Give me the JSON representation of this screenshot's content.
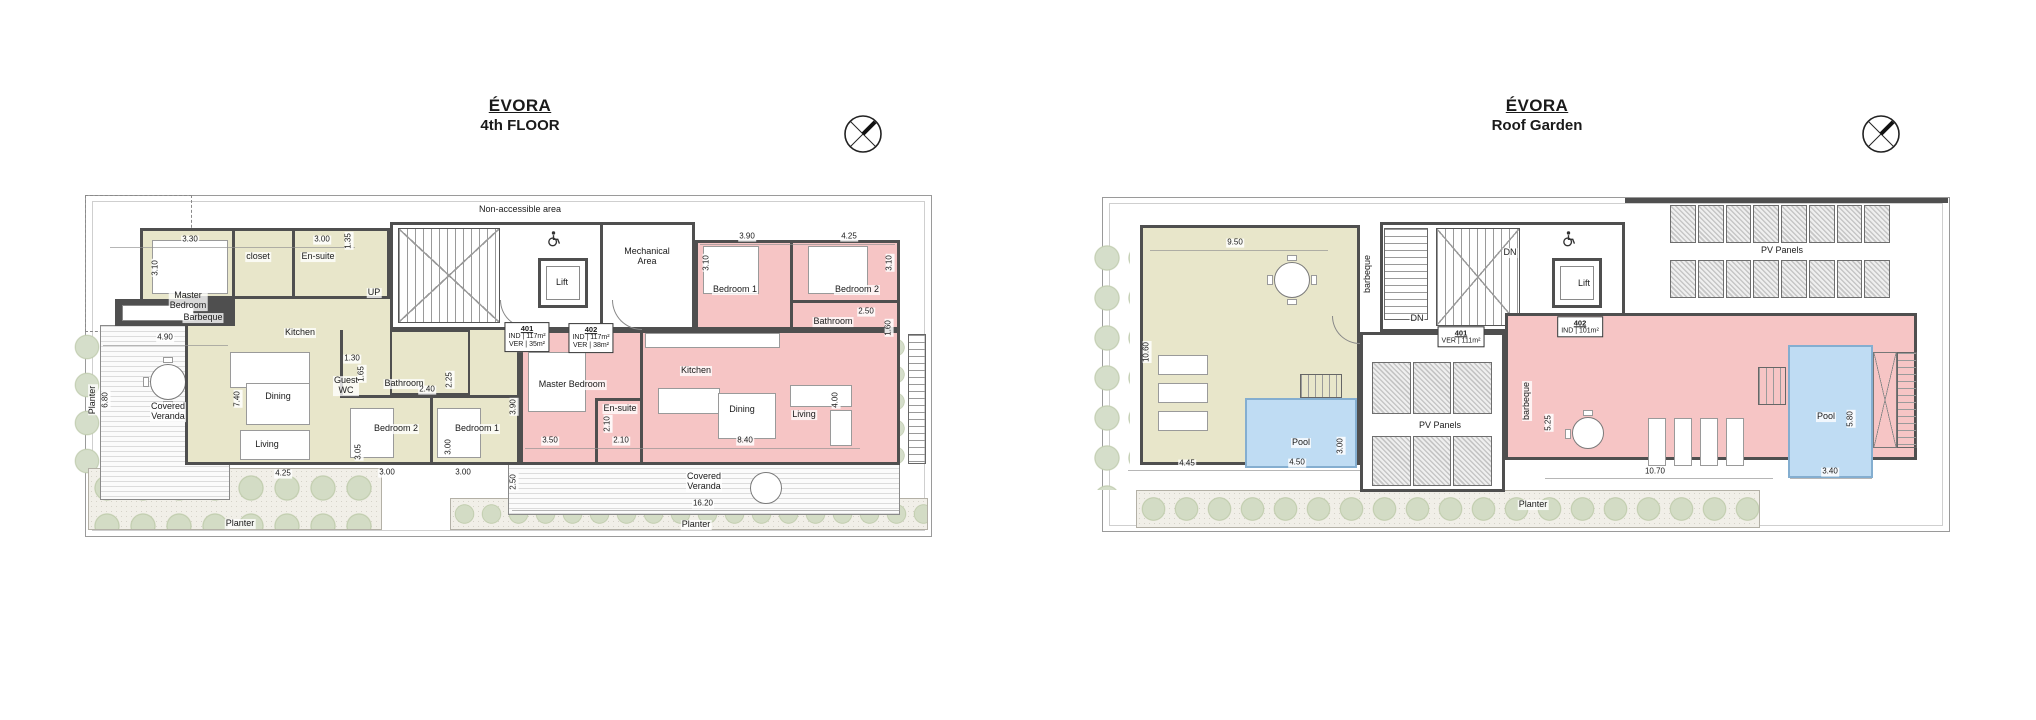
{
  "colors": {
    "unit_401_fill": "#e8e6ca",
    "unit_402_fill": "#f6c5c5",
    "pool_fill": "#bfdcf3",
    "wall": "#4f4f4f",
    "planting": "#d3dcc5"
  },
  "plans": [
    {
      "id": "fourth-floor",
      "title": "ÉVORA",
      "subtitle": "4th FLOOR",
      "room_labels": [
        {
          "t": "Non-accessible area",
          "x": 520,
          "y": 210
        },
        {
          "t": "Master\nBedroom",
          "x": 188,
          "y": 301
        },
        {
          "t": "closet",
          "x": 258,
          "y": 257
        },
        {
          "t": "En-suite",
          "x": 318,
          "y": 257
        },
        {
          "t": "Barbeque",
          "x": 203,
          "y": 318
        },
        {
          "t": "Kitchen",
          "x": 300,
          "y": 333
        },
        {
          "t": "Covered\nVeranda",
          "x": 168,
          "y": 412
        },
        {
          "t": "Dining",
          "x": 278,
          "y": 397
        },
        {
          "t": "Living",
          "x": 267,
          "y": 445
        },
        {
          "t": "Guest\nWC",
          "x": 346,
          "y": 386
        },
        {
          "t": "Bathroom",
          "x": 404,
          "y": 384
        },
        {
          "t": "Bedroom 2",
          "x": 396,
          "y": 429
        },
        {
          "t": "Bedroom 1",
          "x": 477,
          "y": 429
        },
        {
          "t": "UP",
          "x": 374,
          "y": 293
        },
        {
          "t": "Lift",
          "x": 562,
          "y": 283
        },
        {
          "t": "Mechanical\nArea",
          "x": 647,
          "y": 257
        },
        {
          "t": "Master Bedroom",
          "x": 572,
          "y": 385
        },
        {
          "t": "En-suite",
          "x": 620,
          "y": 409
        },
        {
          "t": "Kitchen",
          "x": 696,
          "y": 371
        },
        {
          "t": "Dining",
          "x": 742,
          "y": 410
        },
        {
          "t": "Living",
          "x": 804,
          "y": 415
        },
        {
          "t": "Bathroom",
          "x": 833,
          "y": 322
        },
        {
          "t": "Bedroom 1",
          "x": 735,
          "y": 290
        },
        {
          "t": "Bedroom 2",
          "x": 857,
          "y": 290
        },
        {
          "t": "Covered\nVeranda",
          "x": 704,
          "y": 482
        },
        {
          "t": "Planter",
          "x": 696,
          "y": 525
        },
        {
          "t": "Planter",
          "x": 240,
          "y": 524
        },
        {
          "t": "Planter",
          "x": 93,
          "y": 400,
          "r": -90
        }
      ],
      "dim_labels": [
        {
          "t": "3.30",
          "x": 190,
          "y": 240
        },
        {
          "t": "3.10",
          "x": 156,
          "y": 268,
          "r": -90
        },
        {
          "t": "3.00",
          "x": 322,
          "y": 240
        },
        {
          "t": "1.35",
          "x": 349,
          "y": 241,
          "r": -90
        },
        {
          "t": "4.90",
          "x": 165,
          "y": 338
        },
        {
          "t": "6.80",
          "x": 106,
          "y": 400,
          "r": -90
        },
        {
          "t": "7.40",
          "x": 238,
          "y": 399,
          "r": -90
        },
        {
          "t": "1.30",
          "x": 352,
          "y": 359
        },
        {
          "t": "1.65",
          "x": 362,
          "y": 374,
          "r": -90
        },
        {
          "t": "2.40",
          "x": 427,
          "y": 390
        },
        {
          "t": "2.25",
          "x": 450,
          "y": 380,
          "r": -90
        },
        {
          "t": "3.05",
          "x": 359,
          "y": 452,
          "r": -90
        },
        {
          "t": "3.00",
          "x": 387,
          "y": 473
        },
        {
          "t": "3.00",
          "x": 449,
          "y": 447,
          "r": -90
        },
        {
          "t": "3.00",
          "x": 463,
          "y": 473
        },
        {
          "t": "4.25",
          "x": 283,
          "y": 474
        },
        {
          "t": "3.90",
          "x": 747,
          "y": 237
        },
        {
          "t": "4.25",
          "x": 849,
          "y": 237
        },
        {
          "t": "3.10",
          "x": 707,
          "y": 263,
          "r": -90
        },
        {
          "t": "3.10",
          "x": 890,
          "y": 263,
          "r": -90
        },
        {
          "t": "2.50",
          "x": 866,
          "y": 312
        },
        {
          "t": "1.60",
          "x": 889,
          "y": 328,
          "r": -90
        },
        {
          "t": "3.90",
          "x": 514,
          "y": 407,
          "r": -90
        },
        {
          "t": "3.50",
          "x": 550,
          "y": 441
        },
        {
          "t": "2.10",
          "x": 608,
          "y": 424,
          "r": -90
        },
        {
          "t": "2.10",
          "x": 621,
          "y": 441
        },
        {
          "t": "8.40",
          "x": 745,
          "y": 441
        },
        {
          "t": "4.00",
          "x": 836,
          "y": 400,
          "r": -90
        },
        {
          "t": "2.50",
          "x": 514,
          "y": 482,
          "r": -90
        },
        {
          "t": "16.20",
          "x": 703,
          "y": 504
        }
      ],
      "unit_tags": [
        {
          "lines": [
            "401",
            "IND | 117m²",
            "VER | 35m²"
          ],
          "x": 527,
          "y": 337
        },
        {
          "lines": [
            "402",
            "IND | 117m²",
            "VER | 38m²"
          ],
          "x": 591,
          "y": 338
        }
      ]
    },
    {
      "id": "roof-garden",
      "title": "ÉVORA",
      "subtitle": "Roof Garden",
      "room_labels": [
        {
          "t": "barbeque",
          "x": 1368,
          "y": 274,
          "r": -90
        },
        {
          "t": "DN",
          "x": 1510,
          "y": 253
        },
        {
          "t": "Lift",
          "x": 1584,
          "y": 284
        },
        {
          "t": "PV Panels",
          "x": 1782,
          "y": 251
        },
        {
          "t": "DN",
          "x": 1417,
          "y": 319
        },
        {
          "t": "PV Panels",
          "x": 1440,
          "y": 426
        },
        {
          "t": "barbeque",
          "x": 1527,
          "y": 401,
          "r": -90
        },
        {
          "t": "Pool",
          "x": 1301,
          "y": 443
        },
        {
          "t": "Pool",
          "x": 1826,
          "y": 417
        },
        {
          "t": "Planter",
          "x": 1533,
          "y": 505
        }
      ],
      "dim_labels": [
        {
          "t": "9.50",
          "x": 1235,
          "y": 243
        },
        {
          "t": "10.60",
          "x": 1147,
          "y": 352,
          "r": -90
        },
        {
          "t": "4.45",
          "x": 1187,
          "y": 464
        },
        {
          "t": "4.50",
          "x": 1297,
          "y": 463
        },
        {
          "t": "3.00",
          "x": 1341,
          "y": 446,
          "r": -90
        },
        {
          "t": "5.25",
          "x": 1549,
          "y": 423,
          "r": -90
        },
        {
          "t": "10.70",
          "x": 1655,
          "y": 472
        },
        {
          "t": "3.40",
          "x": 1830,
          "y": 472
        },
        {
          "t": "5.80",
          "x": 1851,
          "y": 419,
          "r": -90
        }
      ],
      "unit_tags": [
        {
          "lines": [
            "401",
            "VER | 111m²"
          ],
          "x": 1461,
          "y": 337
        },
        {
          "lines": [
            "402",
            "IND | 101m²"
          ],
          "x": 1580,
          "y": 327
        }
      ]
    }
  ]
}
